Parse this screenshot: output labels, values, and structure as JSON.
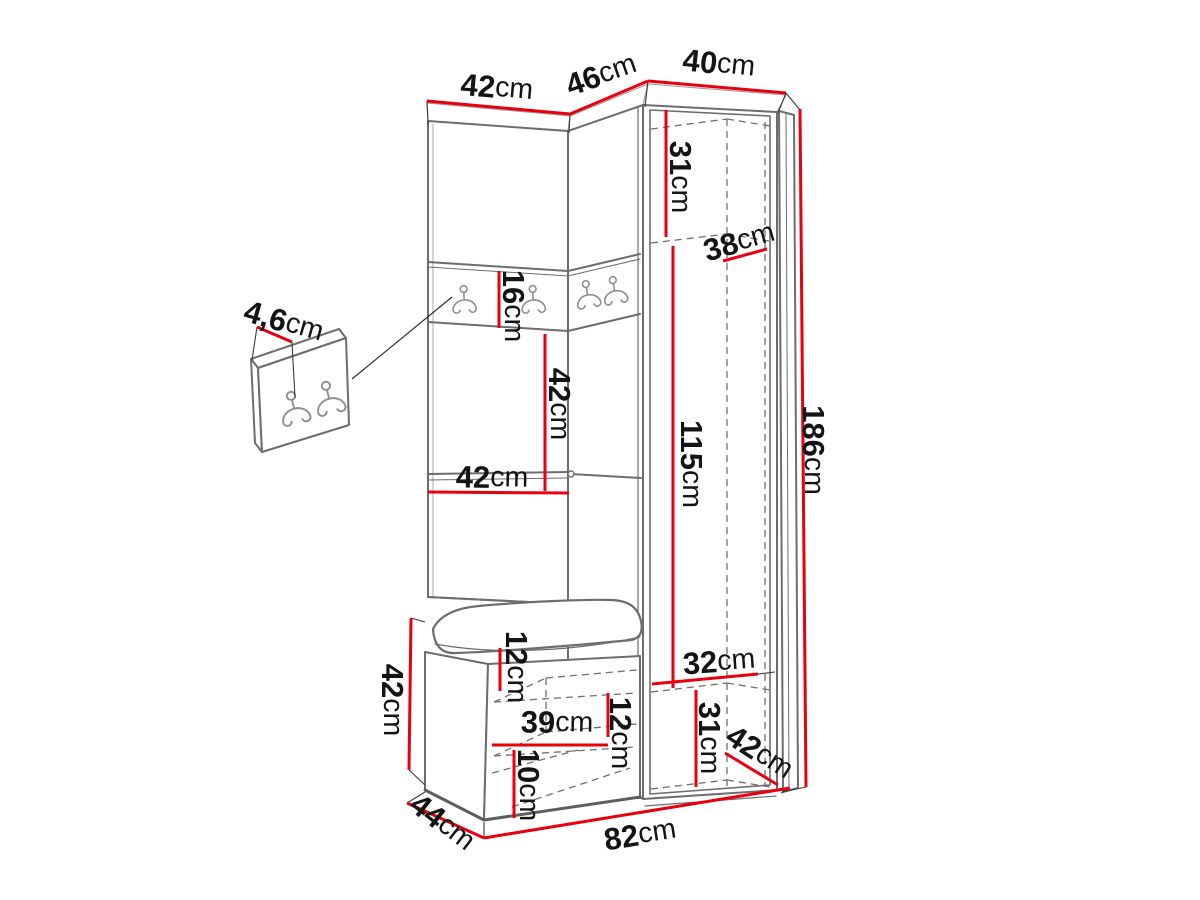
{
  "diagram": {
    "type": "furniture-dimension-drawing",
    "subject": "hallway wardrobe set: corner cabinet with open door, coat-hook panels and shoe bench, plus wall hook panel detail",
    "unit": "cm",
    "colors": {
      "dimension_line": "#e8000f",
      "outline": "#6d6d6d",
      "outline_dark": "#585858",
      "extension_line": "#3a3a3a",
      "dashed_line": "#6f6f6f",
      "hook_stroke": "#8f8f8f",
      "label_text": "#141414",
      "background": "#ffffff"
    },
    "hooks": {
      "strip_hook_count": 4,
      "detail_panel_hook_count": 2
    },
    "labels": [
      {
        "id": "top-left-width",
        "value": "42",
        "unit": "cm",
        "x": 497,
        "y": 87,
        "rotate": 5,
        "line": [
          427,
          101,
          570,
          114
        ]
      },
      {
        "id": "top-corner-depth",
        "value": "46",
        "unit": "cm",
        "x": 601,
        "y": 74,
        "rotate": -19,
        "line": [
          570,
          114,
          648,
          81
        ]
      },
      {
        "id": "top-right-width",
        "value": "40",
        "unit": "cm",
        "x": 719,
        "y": 63,
        "rotate": 6,
        "line": [
          648,
          81,
          786,
          93
        ]
      },
      {
        "id": "cabinet-upper-shelf",
        "value": "31",
        "unit": "cm",
        "x": 681,
        "y": 177,
        "rotate": 90,
        "line": [
          666,
          110,
          666,
          237
        ]
      },
      {
        "id": "cabinet-depth",
        "value": "38",
        "unit": "cm",
        "x": 739,
        "y": 241,
        "rotate": -16,
        "line": [
          723,
          261,
          767,
          249
        ]
      },
      {
        "id": "panel-thickness",
        "value": "4,6",
        "unit": "cm",
        "x": 284,
        "y": 321,
        "rotate": 16,
        "line": [
          257,
          327,
          292,
          342
        ]
      },
      {
        "id": "hook-strip-height",
        "value": "16",
        "unit": "cm",
        "x": 514,
        "y": 306,
        "rotate": 90,
        "line": [
          499,
          271,
          499,
          328
        ]
      },
      {
        "id": "middle-niche-height",
        "value": "42",
        "unit": "cm",
        "x": 560,
        "y": 404,
        "rotate": 90,
        "line": [
          545,
          334,
          545,
          491
        ]
      },
      {
        "id": "left-section-width",
        "value": "42",
        "unit": "cm",
        "x": 492,
        "y": 477,
        "rotate": 1,
        "line": [
          428,
          492,
          569,
          493
        ]
      },
      {
        "id": "cabinet-inner-height",
        "value": "115",
        "unit": "cm",
        "x": 692,
        "y": 464,
        "rotate": 90,
        "line": [
          673,
          246,
          673,
          688
        ]
      },
      {
        "id": "total-height",
        "value": "186",
        "unit": "cm",
        "x": 814,
        "y": 450,
        "rotate": 90,
        "line": [
          800,
          109,
          806,
          787
        ]
      },
      {
        "id": "bench-height",
        "value": "42",
        "unit": "cm",
        "x": 393,
        "y": 700,
        "rotate": 90,
        "line": [
          411,
          618,
          409,
          770
        ]
      },
      {
        "id": "bench-top-offset",
        "value": "12",
        "unit": "cm",
        "x": 517,
        "y": 667,
        "rotate": 90,
        "line": [
          500,
          648,
          500,
          691
        ]
      },
      {
        "id": "bench-inner-width",
        "value": "39",
        "unit": "cm",
        "x": 557,
        "y": 722,
        "rotate": 1,
        "line": [
          492,
          745,
          608,
          745
        ]
      },
      {
        "id": "bench-shelf-gap",
        "value": "12",
        "unit": "cm",
        "x": 621,
        "y": 733,
        "rotate": 90,
        "line": [
          608,
          693,
          608,
          737
        ]
      },
      {
        "id": "bench-lower-gap",
        "value": "10",
        "unit": "cm",
        "x": 529,
        "y": 785,
        "rotate": 90,
        "line": [
          514,
          750,
          514,
          818
        ]
      },
      {
        "id": "bench-depth",
        "value": "44",
        "unit": "cm",
        "x": 443,
        "y": 822,
        "rotate": 38,
        "line": [
          407,
          803,
          484,
          838
        ]
      },
      {
        "id": "total-width",
        "value": "82",
        "unit": "cm",
        "x": 640,
        "y": 834,
        "rotate": -9,
        "line": [
          484,
          838,
          790,
          788
        ]
      },
      {
        "id": "cabinet-inner-width",
        "value": "32",
        "unit": "cm",
        "x": 719,
        "y": 661,
        "rotate": -4,
        "line": [
          652,
          684,
          758,
          674
        ]
      },
      {
        "id": "cabinet-lower-height",
        "value": "31",
        "unit": "cm",
        "x": 710,
        "y": 738,
        "rotate": 90,
        "line": [
          696,
          690,
          696,
          787
        ]
      },
      {
        "id": "cabinet-bottom-depth",
        "value": "42",
        "unit": "cm",
        "x": 760,
        "y": 752,
        "rotate": 33,
        "line": [
          725,
          753,
          778,
          785
        ]
      }
    ]
  }
}
